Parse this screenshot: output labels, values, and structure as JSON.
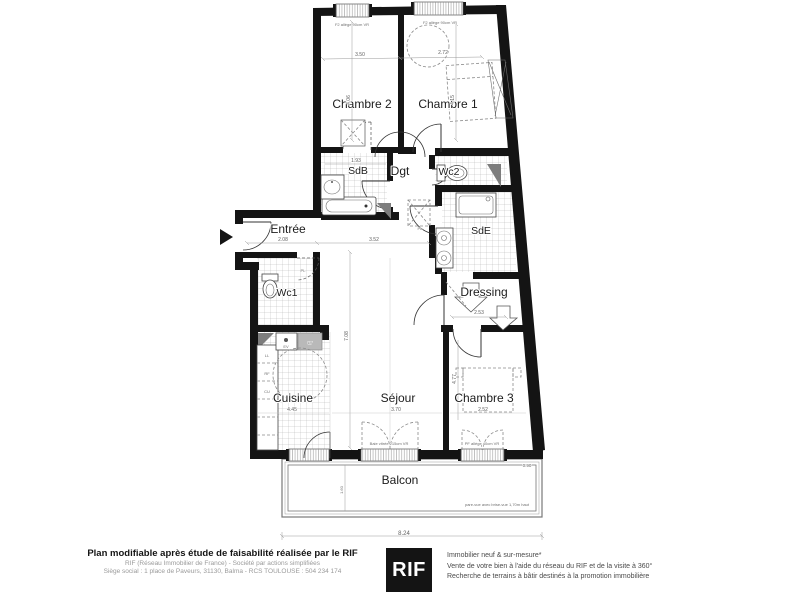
{
  "plan": {
    "rooms": {
      "chambre2": "Chambre 2",
      "chambre1": "Chambre 1",
      "sdb": "SdB",
      "dgt": "Dgt",
      "wc2": "Wc2",
      "sde": "SdE",
      "entree": "Entrée",
      "wc1": "Wc1",
      "dressing": "Dressing",
      "cuisine": "Cuisine",
      "sejour": "Séjour",
      "chambre3": "Chambre 3",
      "balcon": "Balcon"
    },
    "dimensions": {
      "chambre2_width": "3.50",
      "chambre1_width": "2.72",
      "chambre2_height": "4.06",
      "chambre1_height": "4.15",
      "sdb_width": "1.93",
      "entree_width": "2.08",
      "corridor_width": "3.52",
      "sejour_height": "7.08",
      "dressing_width": "2.53",
      "chambre3_height": "4.77",
      "sejour_width": "3.70",
      "chambre3_width": "2.52",
      "cuisine_height": "4.45",
      "balcon_width": "8.24",
      "balcon_side": "0.90",
      "balcon_depth": "1.60"
    },
    "annotations": {
      "window_chambre2": "F2 allège 90cm VR",
      "window_chambre1": "F2 allège 90cm VR",
      "bay_sejour": "Baie vitrée 215cm VR",
      "bay_chambre3": "PF allège 40cm VR",
      "balcony_note": "pare-vue avec brise-vue 1,70m haut",
      "placard": "PL",
      "kitchen_units": [
        "LL",
        "RF",
        "CU",
        "LV",
        "EV"
      ]
    }
  },
  "footer": {
    "title": "Plan modifiable après étude de faisabilité réalisée par le RIF",
    "company_line1": "RIF (Réseau Immobilier de France) - Société par actions simplifiées",
    "company_line2": "Siège social : 1 place de Paveurs, 31130, Balma - RCS TOULOUSE : 504 234 174",
    "logo_text": "RIF",
    "services": [
      "Immobilier neuf & sur-mesure*",
      "Vente de votre bien à l'aide du réseau du RIF et de la visite à 360°",
      "Recherche de terrains à bâtir destinés à la promotion immobilière"
    ]
  },
  "colors": {
    "wall": "#141414",
    "tile_line": "#9a9a9a",
    "dimension": "#6e6e6e",
    "logo_background": "#141414",
    "logo_text": "#ffffff"
  }
}
